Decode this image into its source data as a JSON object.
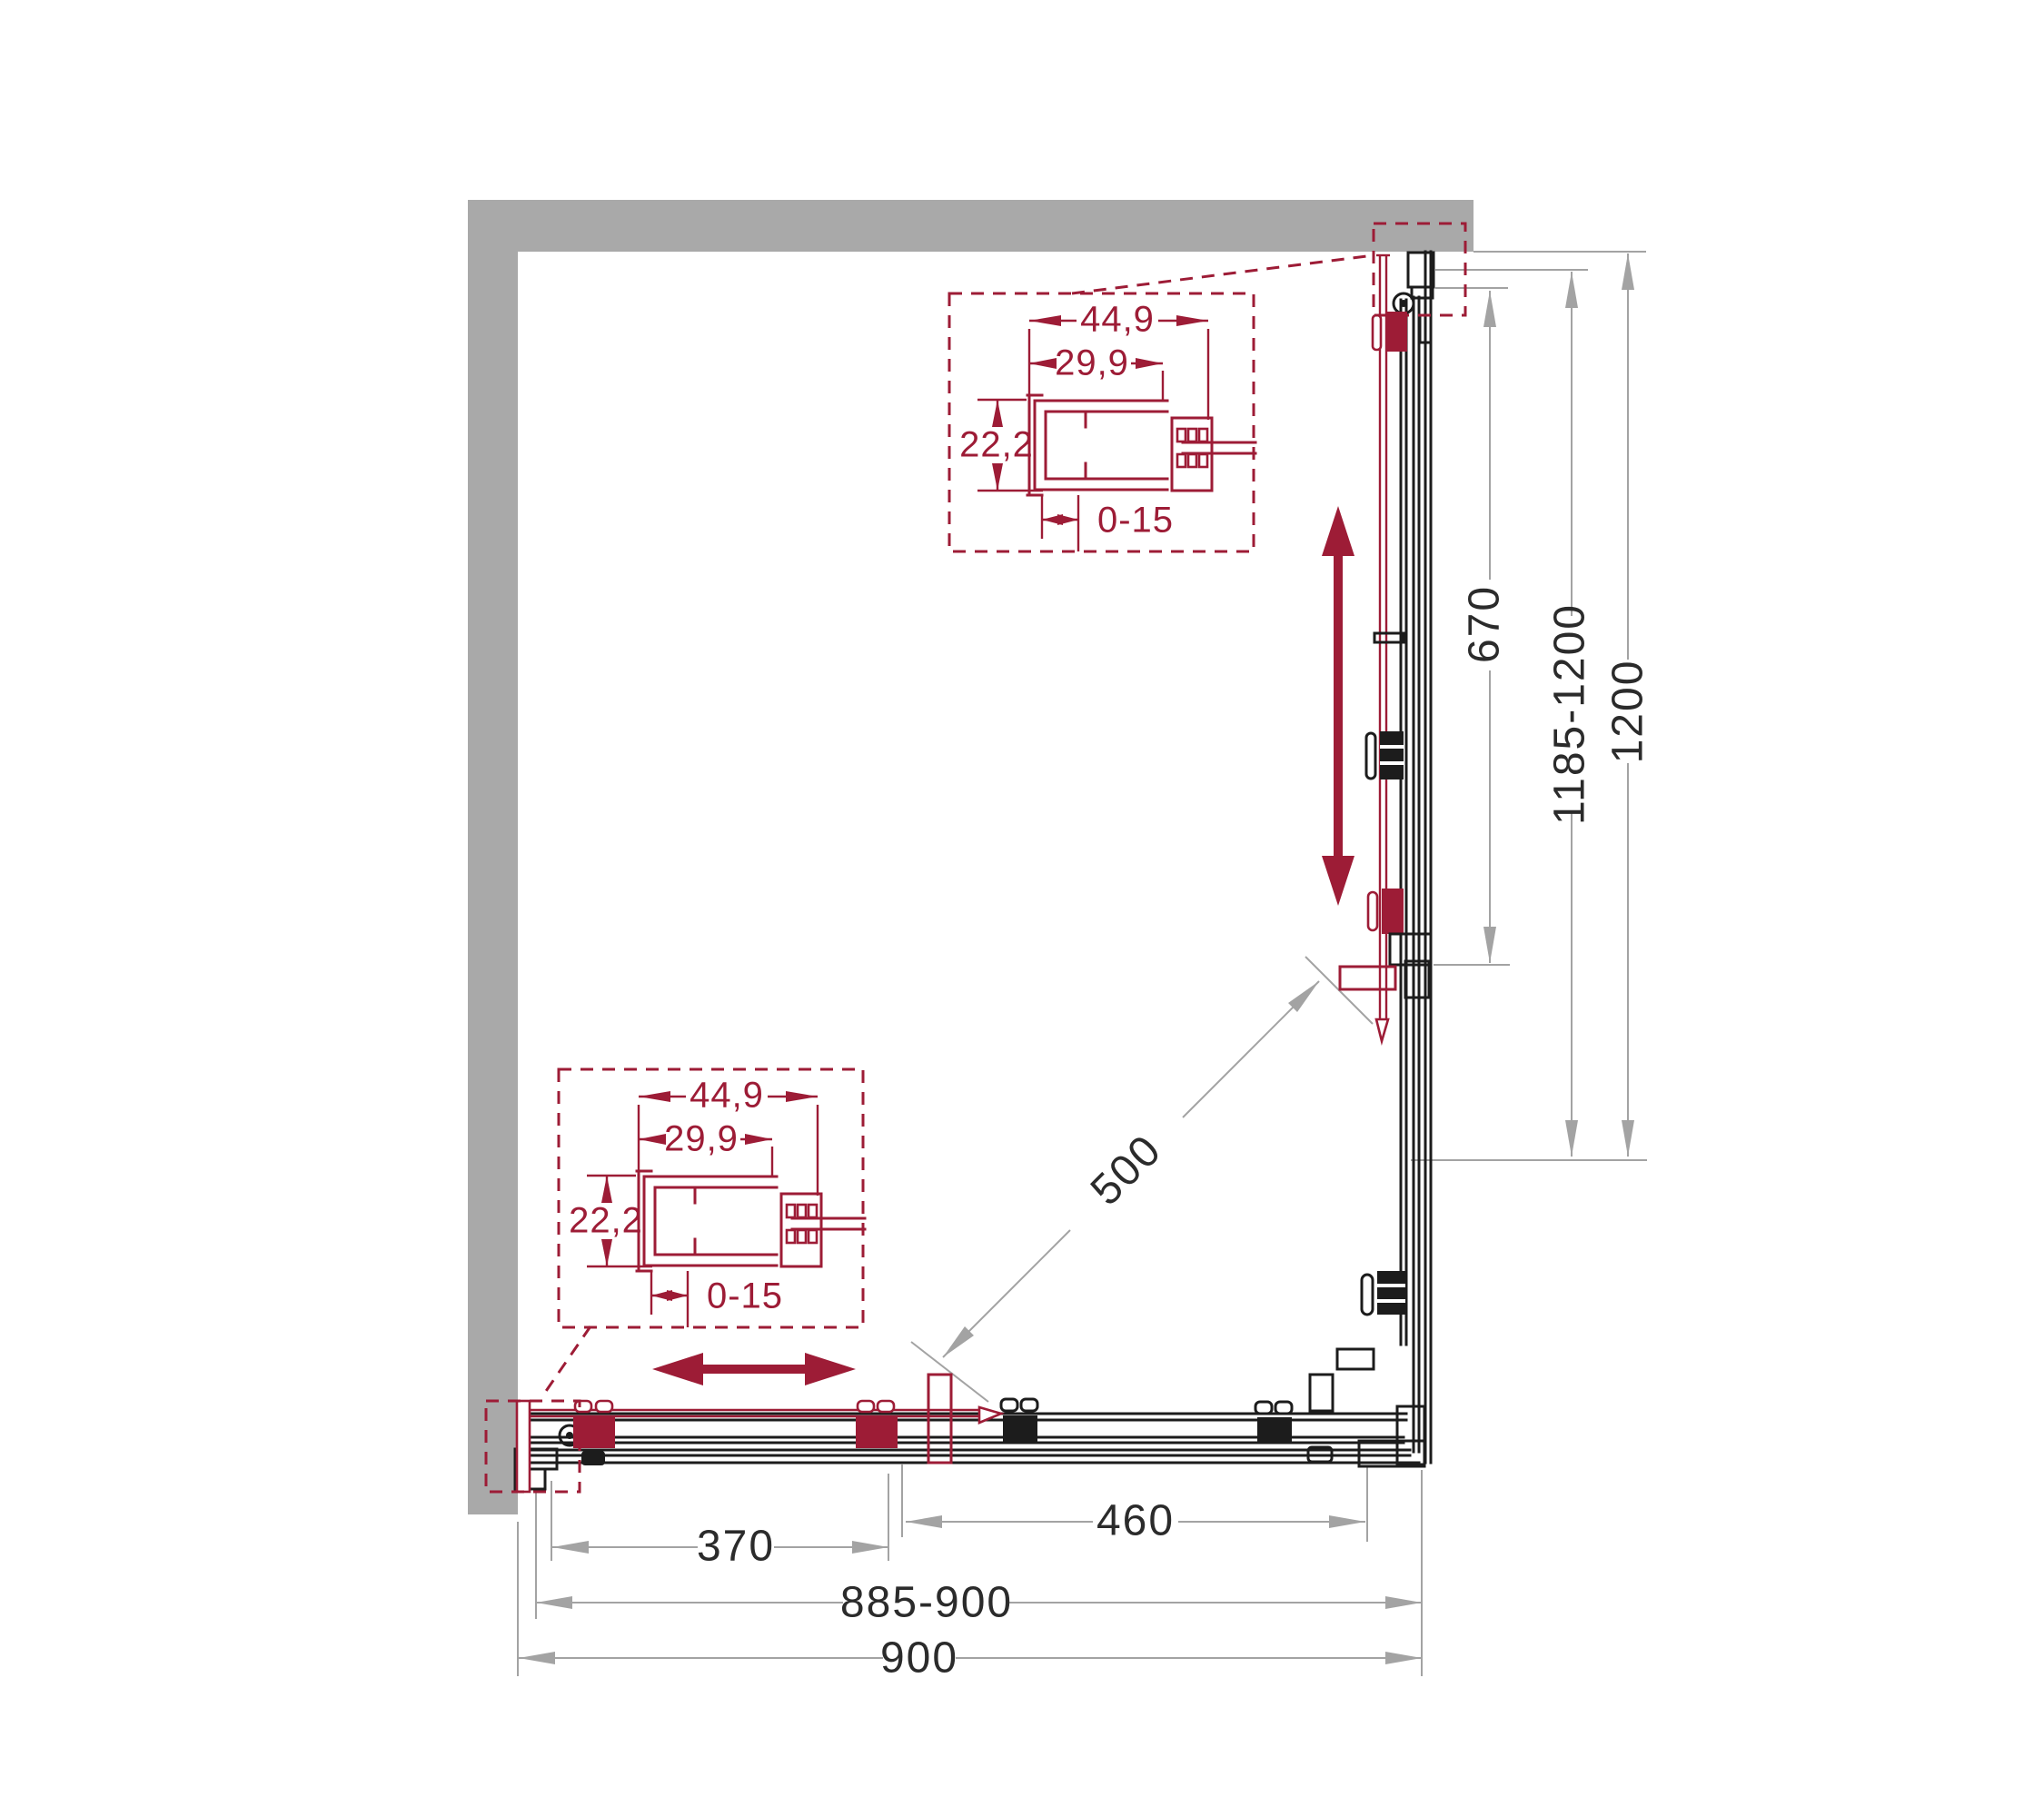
{
  "colors": {
    "accent": "#9d1c36",
    "wall": "#a9a9a9",
    "ink": "#1c1c1c",
    "dim_line": "#a3a3a3",
    "dim_text": "#2b2b2b"
  },
  "dimensions": {
    "bottom": [
      {
        "id": "door-travel-left",
        "label": "370"
      },
      {
        "id": "door-travel-right",
        "label": "460"
      },
      {
        "id": "adjustable-width",
        "label": "885-900"
      },
      {
        "id": "overall-width",
        "label": "900"
      }
    ],
    "right": [
      {
        "id": "fixed-panel-length",
        "label": "670"
      },
      {
        "id": "adjustable-depth",
        "label": "1185-1200"
      },
      {
        "id": "overall-depth",
        "label": "1200"
      }
    ],
    "diagonal": {
      "id": "entry-opening",
      "label": "500"
    }
  },
  "detail_top": {
    "overall_width": "44,9",
    "inner_width": "29,9",
    "profile_height": "22,2",
    "adjustment_range": "0-15"
  },
  "detail_bottom": {
    "overall_width": "44,9",
    "inner_width": "29,9",
    "profile_height": "22,2",
    "adjustment_range": "0-15"
  }
}
